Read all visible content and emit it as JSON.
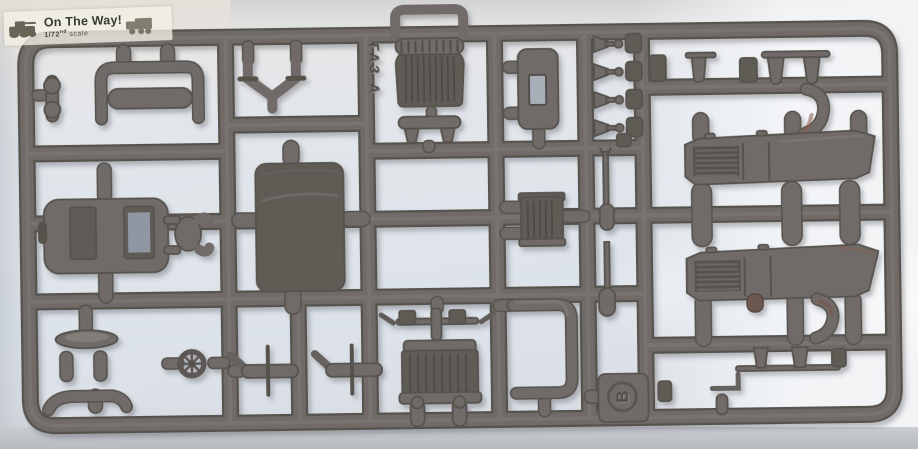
{
  "photo": {
    "description": "Grey injection-moulded plastic model sprue photographed on a pale blue background"
  },
  "watermark": {
    "title": "On The Way!",
    "scale_fraction": "1/72",
    "scale_ordinal": "nd",
    "scale_word": "scale"
  },
  "sprue": {
    "letter": "B",
    "embossed_text": "ГАЗ-А"
  },
  "colors": {
    "plastic": "#6f6b67",
    "plastic_dark": "#56524e",
    "plastic_deep": "#5f5b57",
    "plastic_light": "#847f7a",
    "background": "#e3e7ed",
    "paper": "#f3f0e5",
    "ink": "#333b2c"
  }
}
